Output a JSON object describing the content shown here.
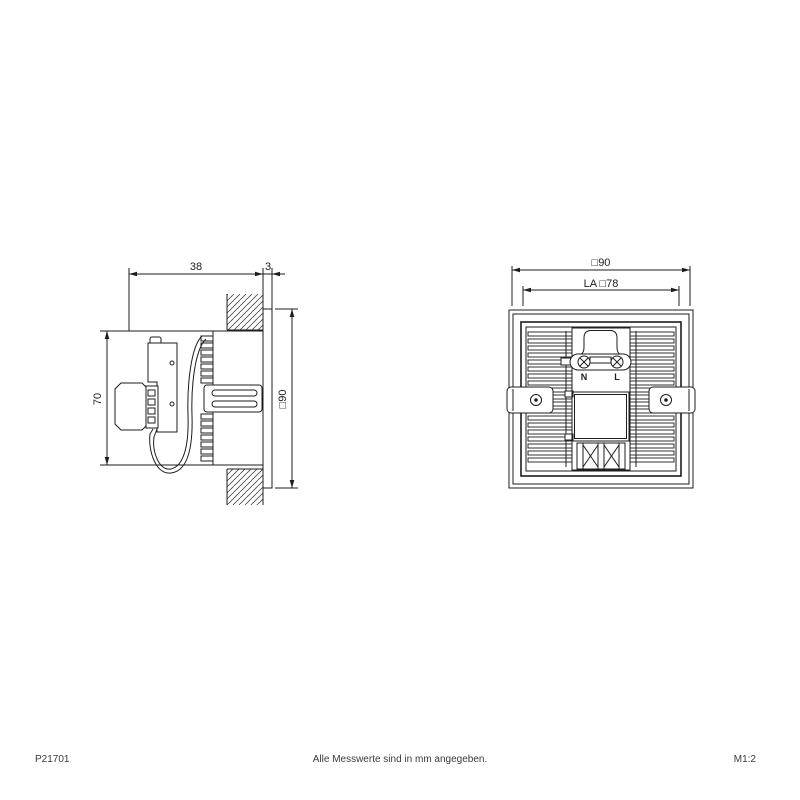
{
  "drawing": {
    "side_view": {
      "dim_depth": "38",
      "dim_frame_thickness": "3",
      "dim_height": "70",
      "dim_face_size": "□90"
    },
    "rear_view": {
      "dim_outer": "□90",
      "dim_cutout": "LA □78",
      "terminal_neutral": "N",
      "terminal_live": "L"
    },
    "colors": {
      "line": "#1d1d1d",
      "background": "#ffffff"
    }
  },
  "footer": {
    "article_number": "P21701",
    "note": "Alle Messwerte sind in mm angegeben.",
    "scale": "M1:2"
  }
}
